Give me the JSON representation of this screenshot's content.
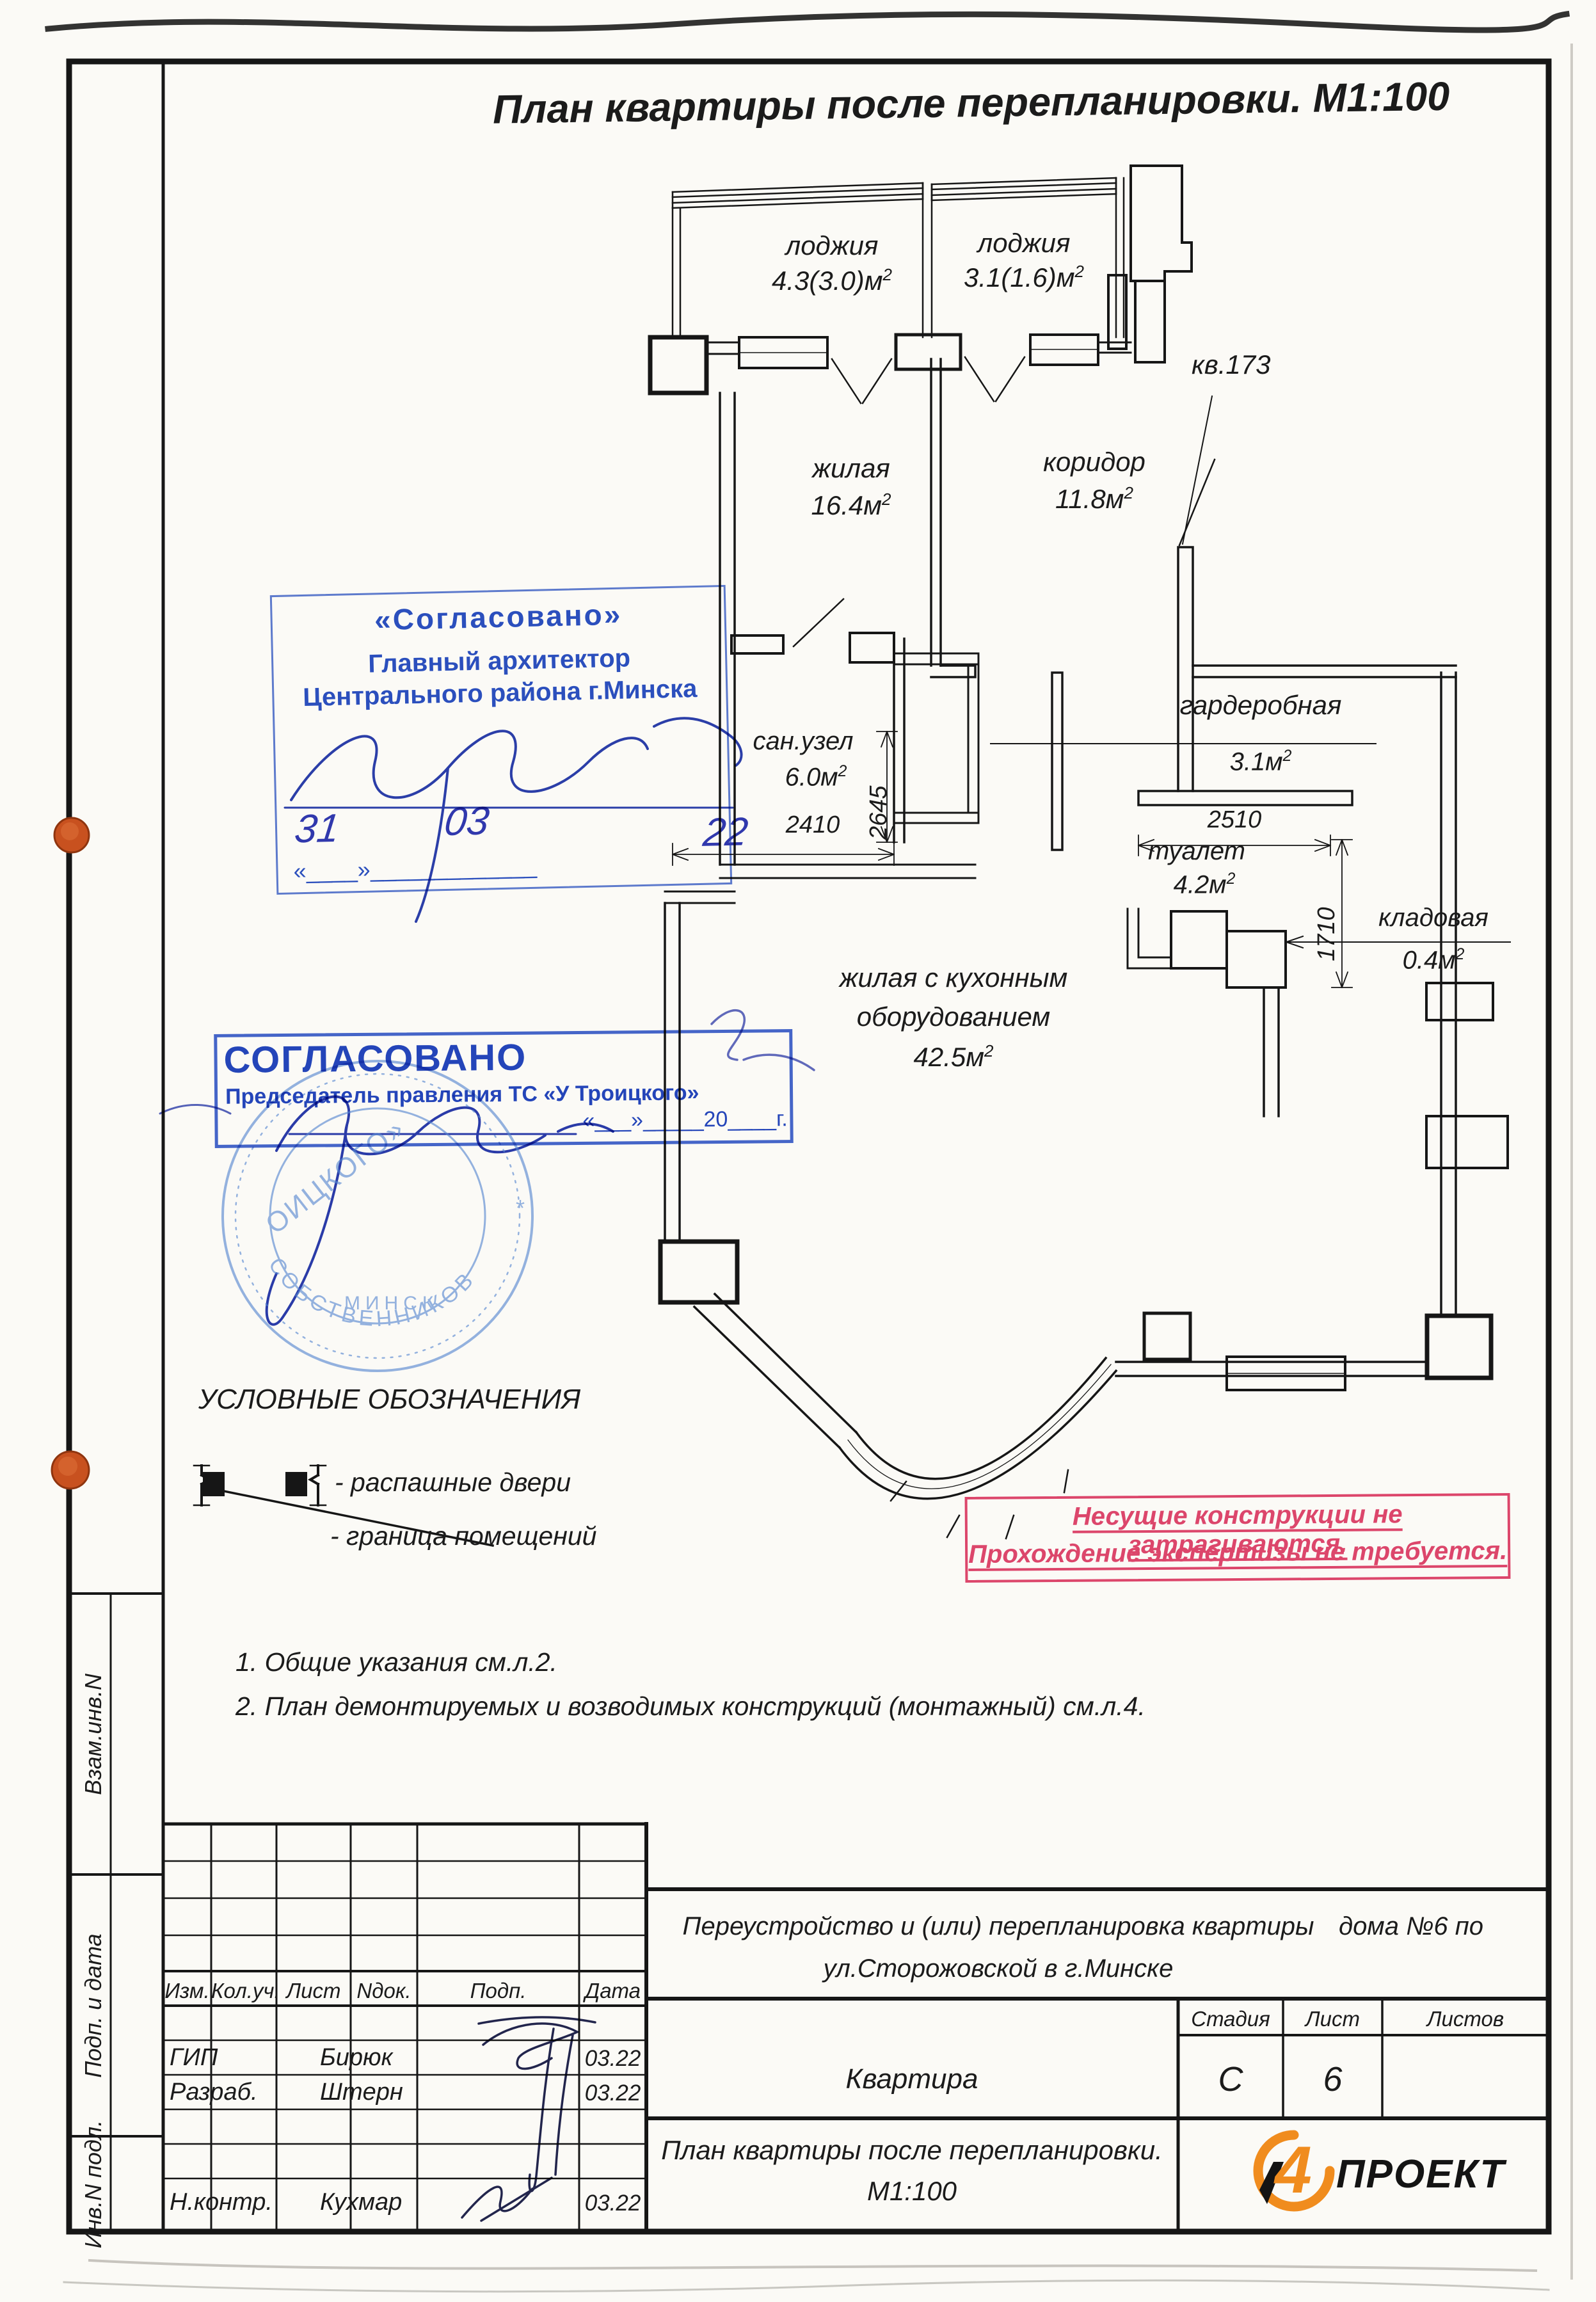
{
  "page": {
    "title": "План квартиры после перепланировки. М1:100"
  },
  "plan": {
    "rooms": {
      "loggia1": {
        "name": "лоджия",
        "area": "4.3(3.0)м",
        "sup": "2"
      },
      "loggia2": {
        "name": "лоджия",
        "area": "3.1(1.6)м",
        "sup": "2"
      },
      "living": {
        "name": "жилая",
        "area": "16.4м",
        "sup": "2"
      },
      "corridor": {
        "name": "коридор",
        "area": "11.8м",
        "sup": "2"
      },
      "bathroom": {
        "name": "сан.узел",
        "area": "6.0м",
        "sup": "2"
      },
      "wardrobe": {
        "name": "гардеробная",
        "area": "3.1м",
        "sup": "2"
      },
      "toilet": {
        "name": "туалет",
        "area": "4.2м",
        "sup": "2"
      },
      "storage": {
        "name": "кладовая",
        "area": "0.4м",
        "sup": "2"
      },
      "kitchen_living": {
        "name_line1": "жилая с кухонным",
        "name_line2": "оборудованием",
        "area": "42.5м",
        "sup": "2"
      }
    },
    "neighbor_apartment": "кв.173",
    "dimensions": {
      "san_depth": "2645",
      "san_width": "2410",
      "toilet_width": "2510",
      "toilet_depth": "1710"
    }
  },
  "stamps": {
    "architect": {
      "line1": "«Согласовано»",
      "line2": "Главный архитектор",
      "line3": "Центрального района г.Минска",
      "hand_day": "31",
      "hand_month": "03",
      "hand_year": "22",
      "date_blank": "«____»_____________"
    },
    "association": {
      "title": "СОГЛАСОВАНО",
      "subtitle": "Председатель правления ТС «У Троицкого»",
      "date_blank": "«___»_____20____г."
    },
    "seal": {
      "inner": "ОИЦКОГО»",
      "ring": "СОБСТВЕННИКОВ",
      "city": "МИНСК"
    }
  },
  "legend": {
    "title": "УСЛОВНЫЕ ОБОЗНАЧЕНИЯ",
    "items": [
      {
        "label": "- распашные двери"
      },
      {
        "label": "- граница помещений"
      }
    ]
  },
  "notice": {
    "line1": "Несущие конструкции не затрагиваются.",
    "line2": "Прохождение экспертизы не требуется."
  },
  "notes": [
    "1. Общие указания см.л.2.",
    "2. План демонтируемых и возводимых конструкций (монтажный) см.л.4."
  ],
  "titleblock": {
    "columns": [
      "Изм.",
      "Кол.уч.",
      "Лист",
      "Nдок.",
      "Подп.",
      "Дата"
    ],
    "rows": [
      {
        "role": "ГИП",
        "name": "Бирюк",
        "date": "03.22"
      },
      {
        "role": "Разраб.",
        "name": "Штерн",
        "date": "03.22"
      },
      {
        "role": "Н.контр.",
        "name": "Кухмар",
        "date": "03.22"
      }
    ],
    "project_line1a": "Переустройство и (или) перепланировка квартиры",
    "project_line1b": "дома №6 по",
    "project_line2": "ул.Сторожовской в г.Минске",
    "object_label": "Квартира",
    "stage_label": "Стадия",
    "sheet_label": "Лист",
    "sheets_label": "Листов",
    "stage_value": "С",
    "sheet_value": "6",
    "sheets_value": "",
    "drawing_title_line1": "План квартиры после перепланировки.",
    "drawing_title_line2": "М1:100",
    "logo": {
      "digit": "4",
      "text": "ПРОЕКТ"
    }
  },
  "margin_labels": [
    "Взам.инв.N",
    "Подп. и дата",
    "Инв.N подл."
  ],
  "colors": {
    "stamp_blue": "#2b50c4",
    "notice_pink": "#e0476f",
    "logo_orange": "#f08c1e"
  }
}
